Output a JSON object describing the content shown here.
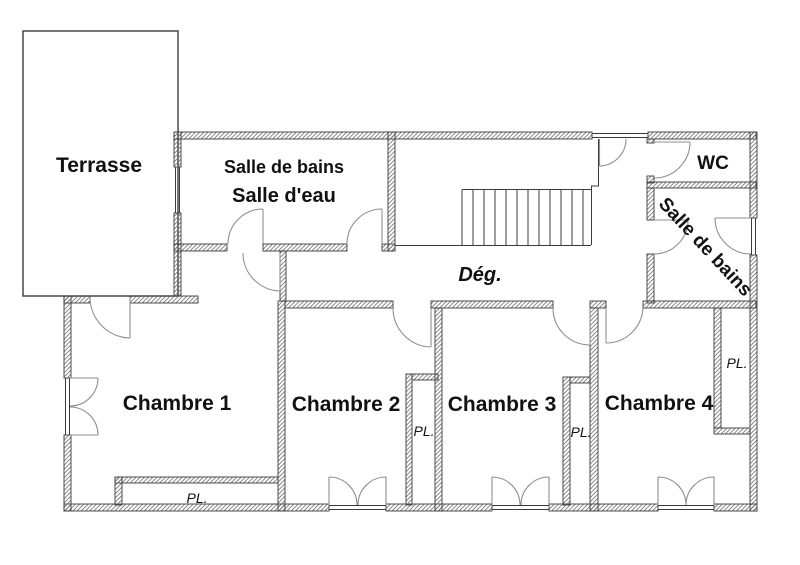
{
  "labels": {
    "terrasse": "Terrasse",
    "salle_de_bains_top": "Salle de bains",
    "salle_d_eau": "Salle d'eau",
    "wc": "WC",
    "salle_de_bains_right": "Salle de bains",
    "degagement": "Dég.",
    "chambre_1": "Chambre 1",
    "chambre_2": "Chambre 2",
    "chambre_3": "Chambre 3",
    "chambre_4": "Chambre 4",
    "placard": "PL."
  },
  "colors": {
    "background": "#ffffff",
    "wall_line": "#3b3b3b",
    "hatch": "#6e6e6e",
    "door_arc": "#8f8f8f",
    "text": "#111111"
  }
}
